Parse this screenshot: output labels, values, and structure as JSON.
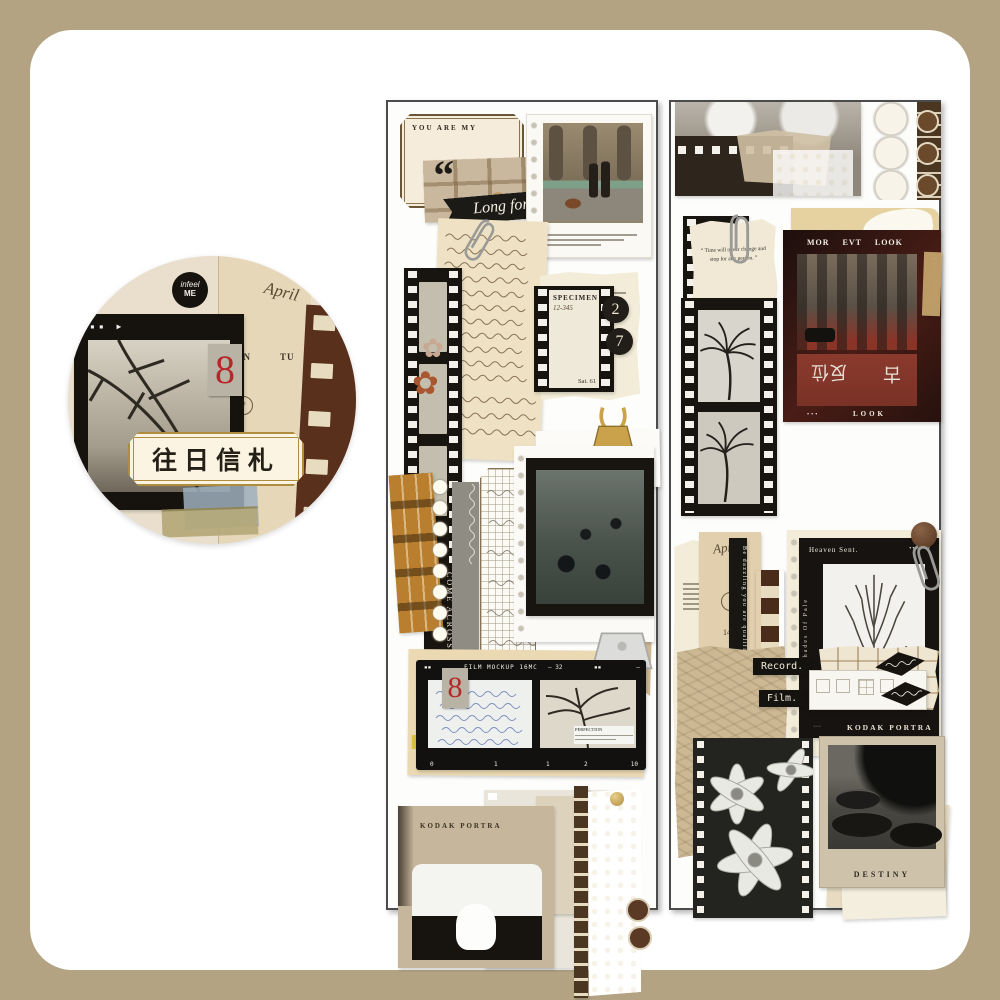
{
  "page": {
    "bg": "#b3a383",
    "canvas": "#ffffff"
  },
  "badge": {
    "label": "往日信札",
    "logo_top": "infeel",
    "logo_bottom": "ME",
    "number": "8",
    "month": "April",
    "cal_col1": "MON",
    "cal_col2": "TU",
    "day1": "7",
    "day2": "14",
    "day3": "21",
    "frame_marks": "▪▪ ▶"
  },
  "left": {
    "ticket": "YOU ARE MY",
    "quote": "“",
    "ribbon": "Long for",
    "film_tab": "COME ACROSS",
    "spec_title": "SPECIMEN",
    "spec_code": "12-345",
    "spec_corner": "Sat. 61",
    "spec_n1": "2",
    "spec_n2": "7",
    "mock_marks_l": "▪▪",
    "mock_title": "FILM MOCKUP 16MC",
    "mock_counter": "— 32",
    "mock_marks_r": "▪▪",
    "mock_dash": "—",
    "mock_number": "8",
    "mock_caption": "PERFECTION",
    "scale0": "0",
    "scale1": "1",
    "scale2": "1",
    "scale3": "2",
    "scale4": "10",
    "kodak": "KODAK PORTRA"
  },
  "right": {
    "note_q1": "“",
    "note": "Time will never change and stop for any person.",
    "note_q2": "”",
    "card_header": "MOR EVT LOOK",
    "card_side": "AF22 CHIC",
    "card_footer_dots": "•••",
    "card_footer": "LOOK",
    "road1": "古",
    "road2": "反位",
    "ribbon": "Be dazzling you are qualified",
    "month": "April",
    "day1": "7",
    "day2": "14",
    "day3": "21",
    "heaven_title": "Heaven Sent.",
    "heaven_dots": "•••••••",
    "heaven_side": "Shades Of Pale",
    "heaven_footer_dots": "····",
    "heaven_footer": "KODAK PORTRA",
    "record": "Record.",
    "film": "Film.",
    "polaroid": "DESTINY"
  }
}
